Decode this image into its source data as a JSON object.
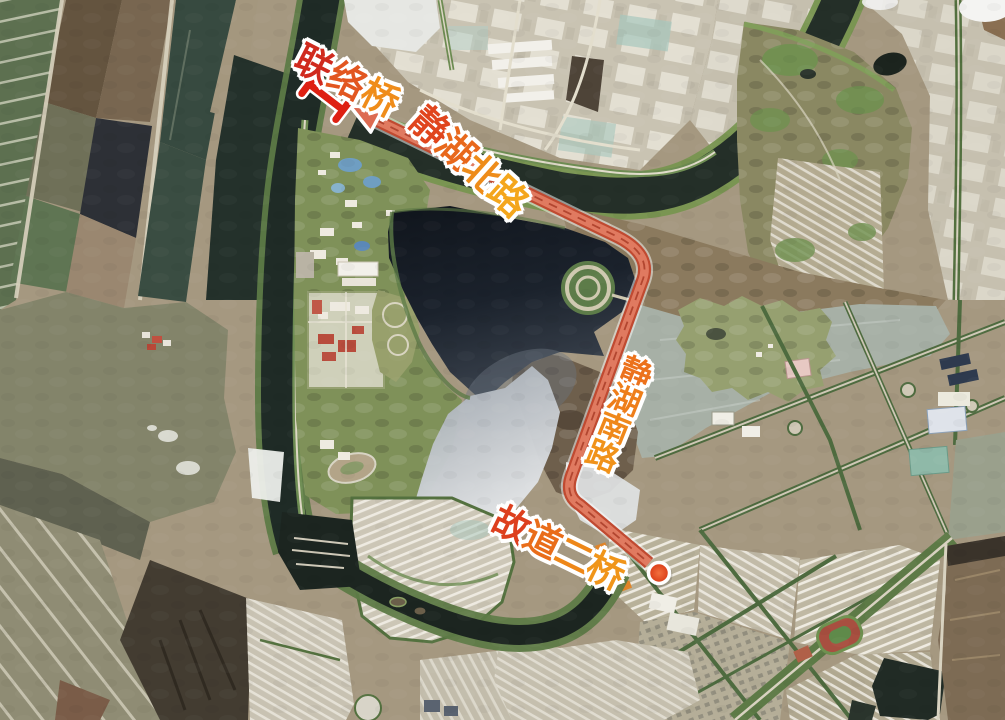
{
  "map": {
    "labels": {
      "lianluoqiao": {
        "text": "联络桥",
        "char_colors": [
          "#d02a1e",
          "#e25620",
          "#ef8c1a"
        ]
      },
      "jinghu_north_road": {
        "text": "静湖北路",
        "char_colors": [
          "#e0451d",
          "#e8681c",
          "#ee8c1a",
          "#f4a61c"
        ]
      },
      "jinghu_south_road": {
        "text": "静湖南路",
        "char_colors": [
          "#ec721c",
          "#ee7e1a",
          "#ef881a",
          "#f0921a"
        ]
      },
      "gudao_er_bridge": {
        "text": "故道二桥",
        "char_colors": [
          "#dd3f1e",
          "#e96d1a",
          "#ee8718",
          "#f0951a"
        ]
      }
    },
    "route": {
      "color_main": "#c04a31",
      "color_highlight": "#e07a60",
      "color_lane": "#a63a24",
      "arrow_color": "#dd6b52",
      "start_marker_color": "#de2012",
      "end_dot_color": "#e64a26"
    }
  }
}
